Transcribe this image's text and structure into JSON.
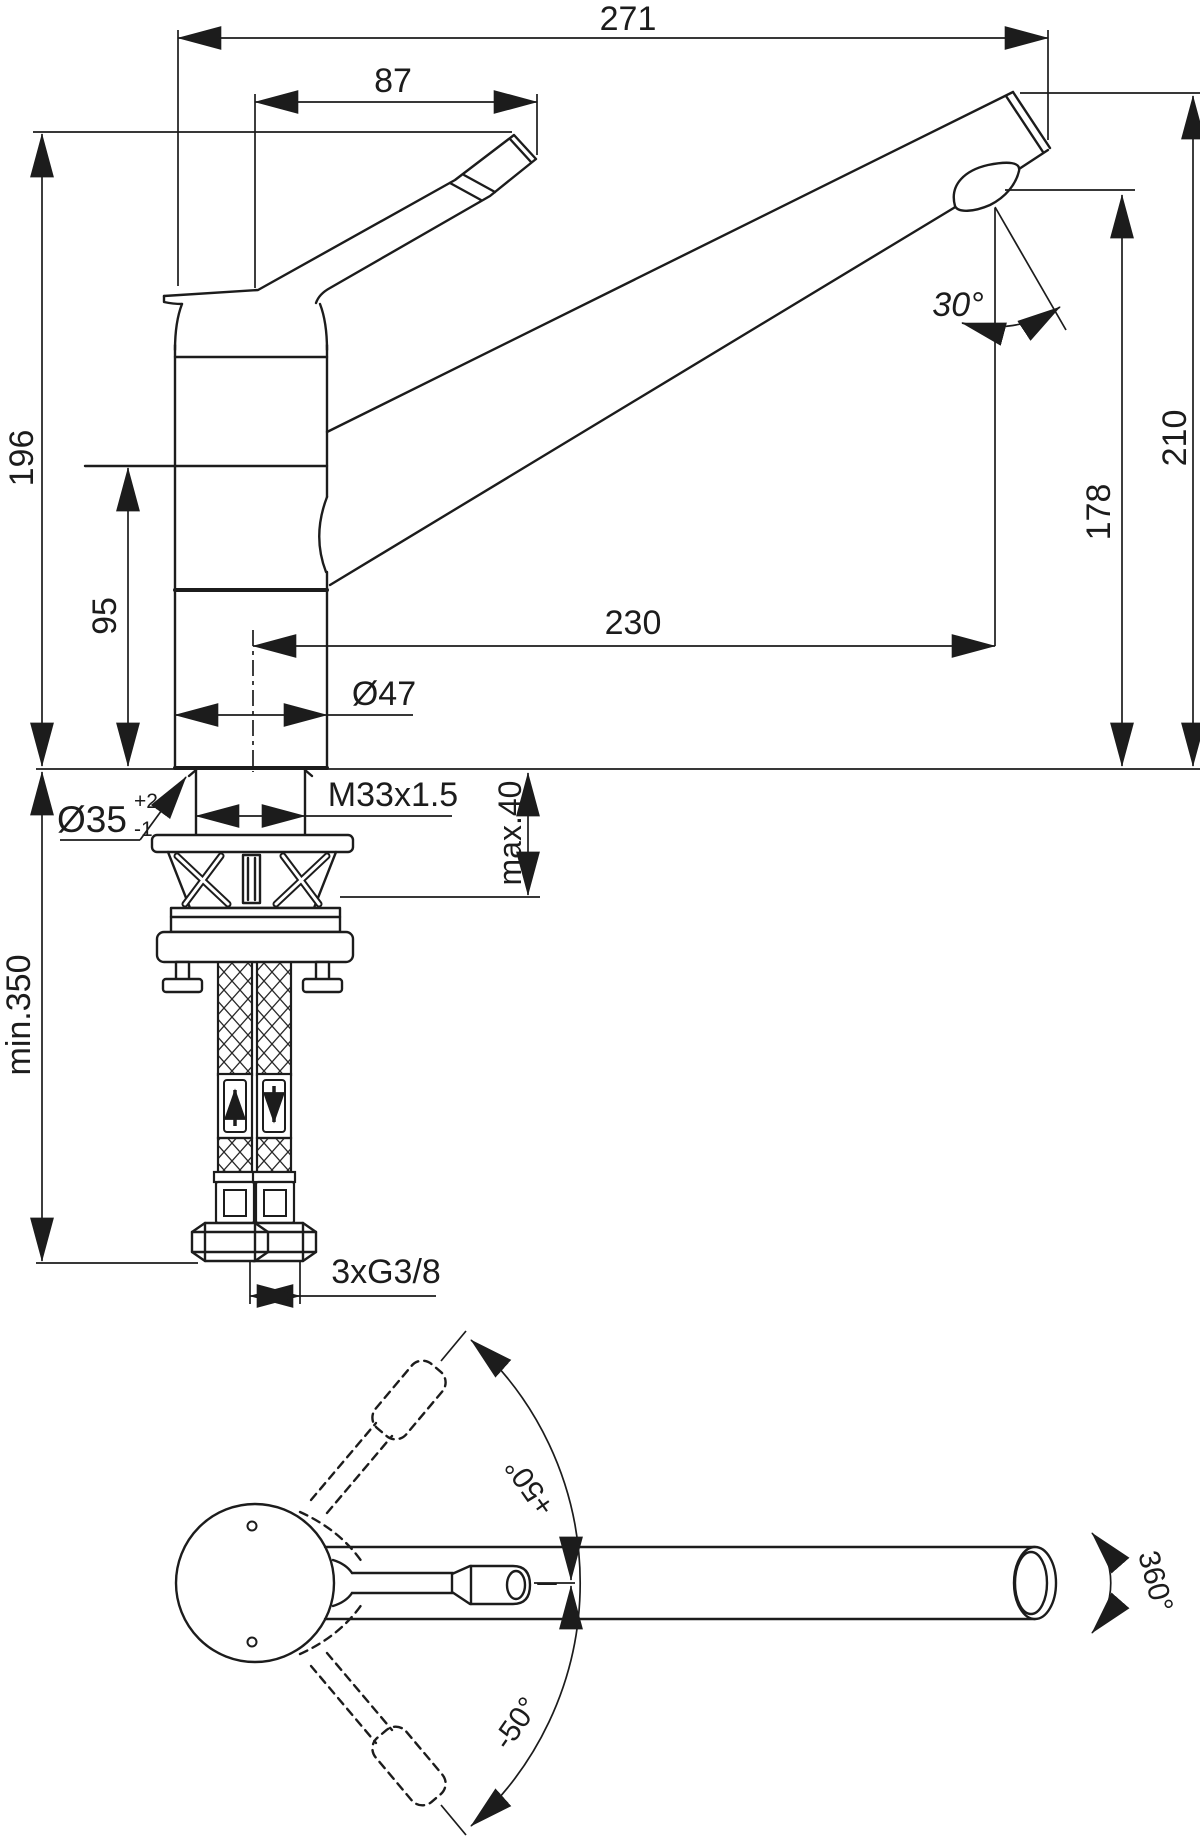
{
  "drawing": {
    "type": "faucet-installation-dimension-drawing",
    "colors": {
      "line": "#1c1c1c",
      "background": "#ffffff"
    },
    "dims": {
      "overall_reach": "271",
      "handle_projection": "87",
      "body_height": "196",
      "lower_body_height": "95",
      "spout_outlet_height": "178",
      "overall_height": "210",
      "spout_reach": "230",
      "spout_angle": "30°",
      "body_diameter": "Ø47",
      "hole_diameter": "Ø35",
      "hole_tolerance_plus": "+2",
      "hole_tolerance_minus": "-1",
      "shank_thread": "M33x1.5",
      "max_deck_thickness": "max.40",
      "min_hose_length": "min.350",
      "supply_connections": "3xG3/8",
      "handle_swing_up": "+50°",
      "handle_swing_down": "-50°",
      "spout_rotation": "360°"
    }
  }
}
